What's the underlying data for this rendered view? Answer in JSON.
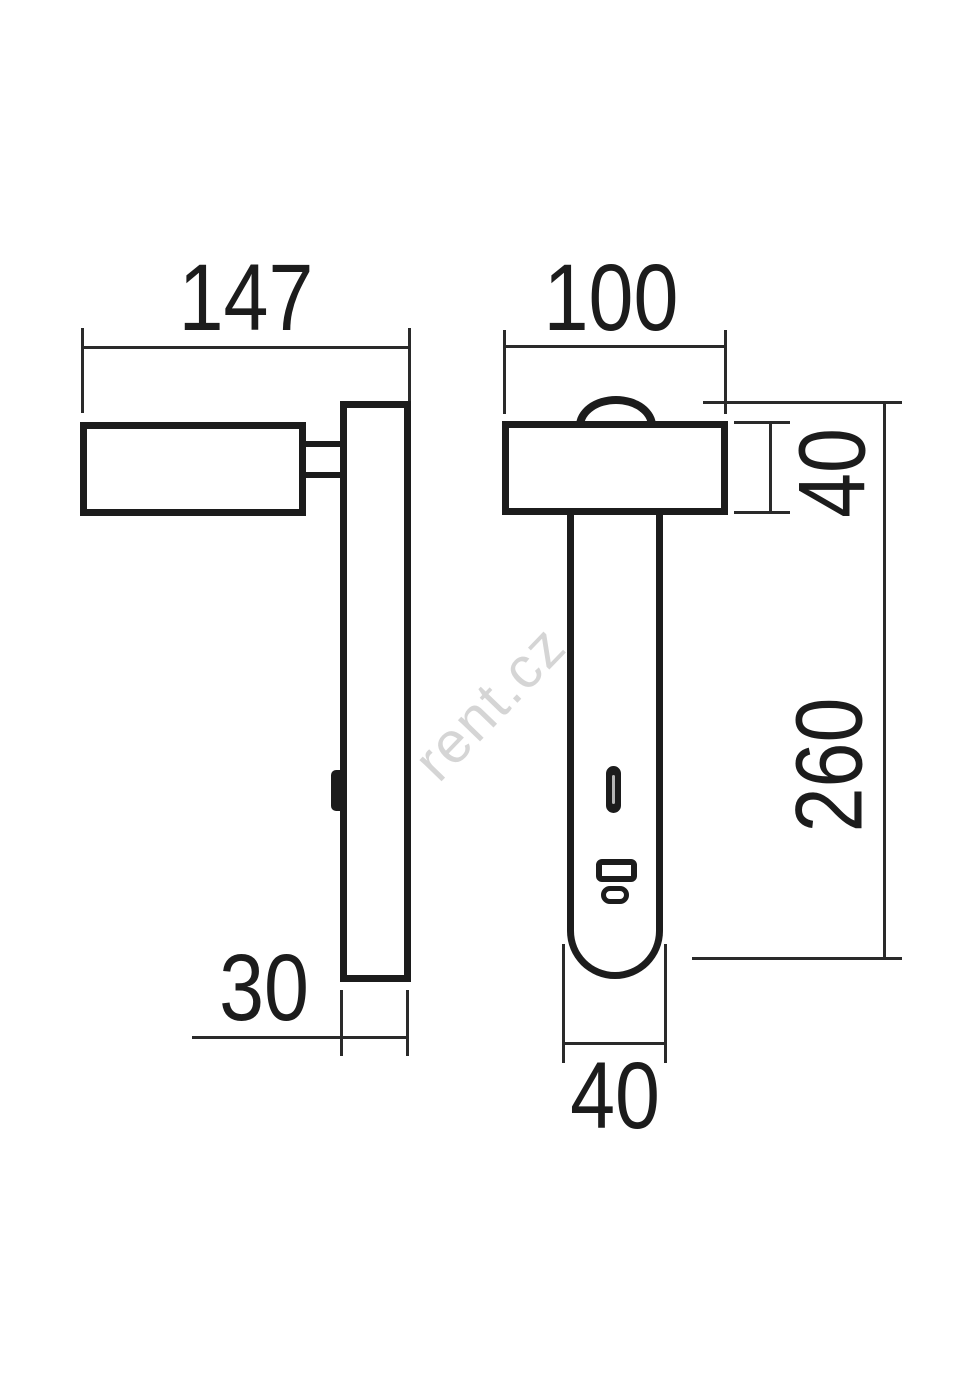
{
  "drawing": {
    "type": "technical-dimension-drawing",
    "subject": "wall-mounted reading lamp, side and front orthographic views",
    "ink_color": "#1c1c1c",
    "background_color": "#ffffff"
  },
  "watermark": {
    "text": "rent.cz",
    "color": "#d5d5d5"
  },
  "dimensions": {
    "side_width": "147",
    "front_width": "100",
    "head_height": "40",
    "body_length": "260",
    "plate_depth": "30",
    "body_width": "40"
  }
}
